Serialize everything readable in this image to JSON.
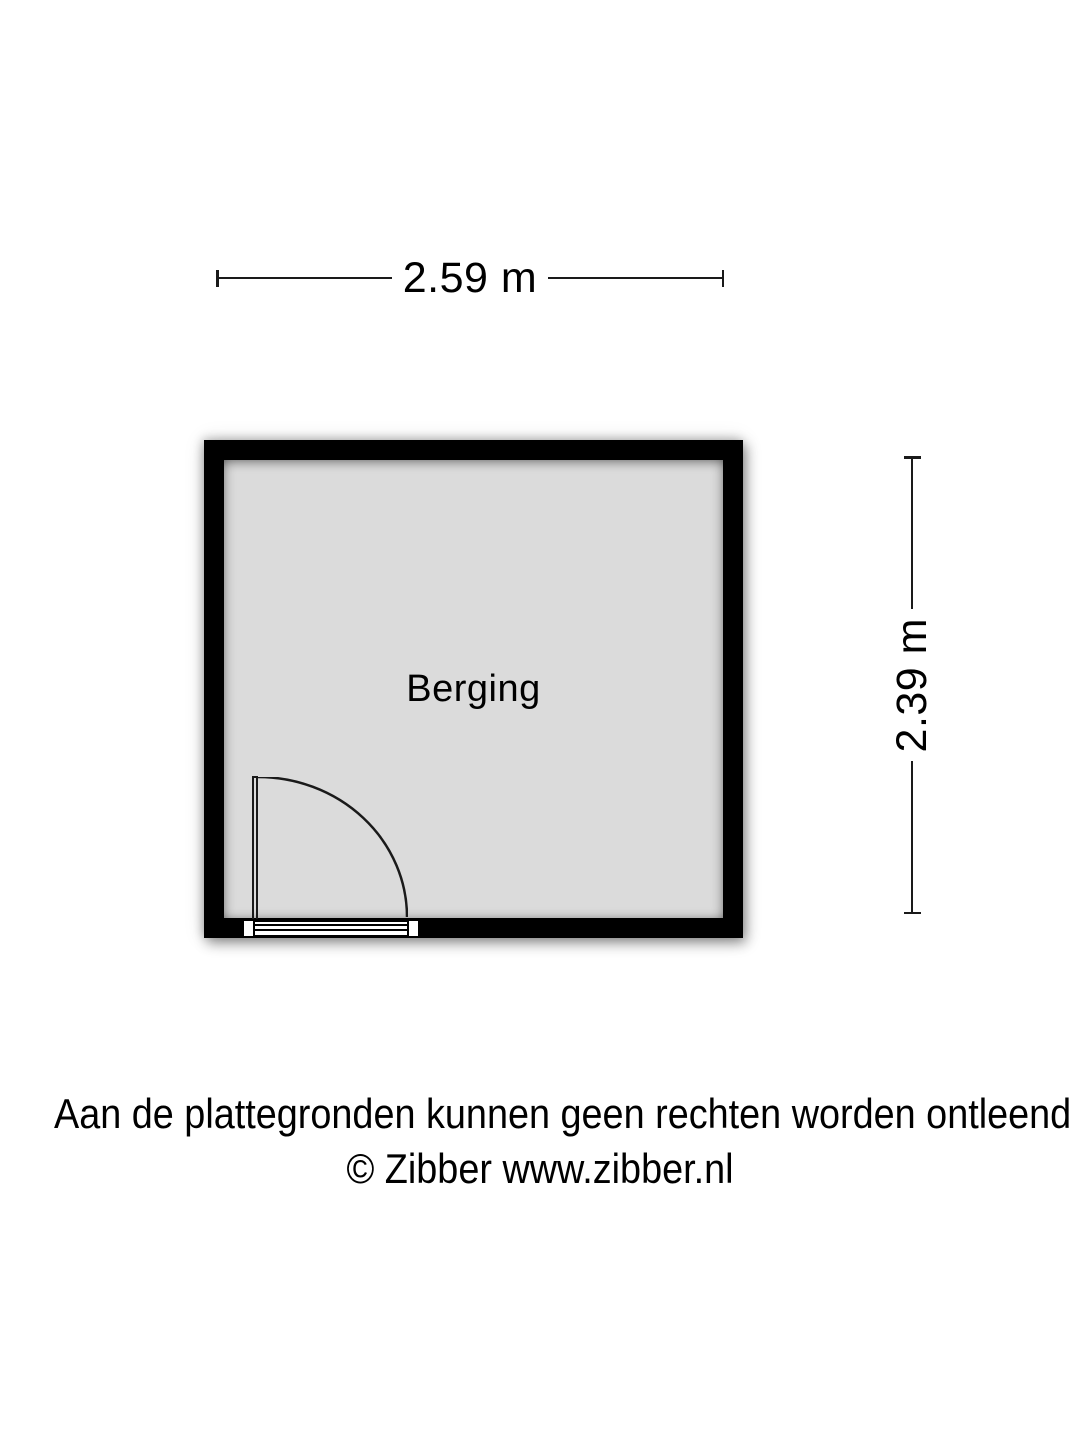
{
  "floorplan": {
    "room": {
      "label": "Berging"
    },
    "dimensions": {
      "width_label": "2.59 m",
      "height_label": "2.39 m"
    },
    "footer": {
      "line1": "Aan de plattegronden kunnen geen rechten worden ontleend",
      "line2": "© Zibber www.zibber.nl"
    },
    "colors": {
      "wall": "#000000",
      "floor": "#dbdbdb",
      "background": "#ffffff",
      "line": "#1a1a1a"
    }
  }
}
